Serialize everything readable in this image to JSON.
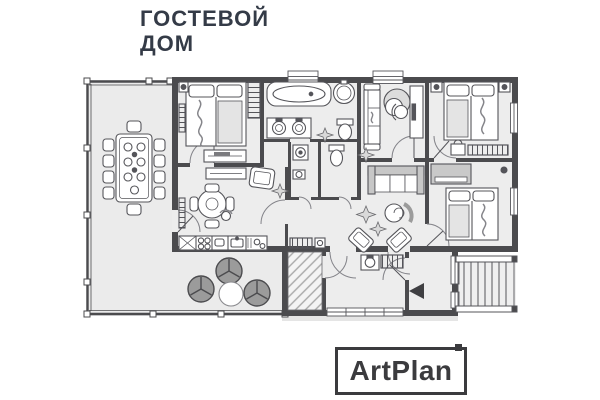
{
  "page": {
    "background_color": "#ffffff"
  },
  "header": {
    "title_line1": "ГОСТЕВОЙ",
    "title_line2": "ДОМ",
    "color": "#343b47"
  },
  "logo": {
    "text": "ArtPlan",
    "color": "#3b3b3e"
  },
  "plan": {
    "colors": {
      "walls": "#4b4b4e",
      "floor": "#ededed",
      "terrace_floor": "#ebebeb",
      "furniture_stroke": "#55555a",
      "soft_gray": "#c7c7c7",
      "lounge_chair_gray": "#9b9b9b",
      "hatch_gray": "#a8a8a8",
      "entrance_arrow": "#3f3f42"
    },
    "icons": [
      "dining-table-icon",
      "chair-icon",
      "lounge-chair-icon",
      "coffee-table-icon",
      "bed-icon",
      "wardrobe-icon",
      "nightstand-icon",
      "lamp-icon",
      "radiator-icon",
      "bathtub-icon",
      "round-basin-icon",
      "double-sink-icon",
      "toilet-icon",
      "washing-machine-icon",
      "small-sink-icon",
      "sofa-icon",
      "egg-chair-icon",
      "desk-icon",
      "office-chair-icon",
      "tv-console-icon",
      "kitchen-counter-icon",
      "hob-icon",
      "kitchen-sink-icon",
      "round-table-icon",
      "person-icon",
      "plant-icon",
      "pouf-icon",
      "armchair-icon",
      "boiler-icon",
      "washbasin-icon",
      "vestibule-hatch",
      "entrance-arrow-icon",
      "stairs-icon",
      "window-icon",
      "door-arc-icon"
    ]
  }
}
